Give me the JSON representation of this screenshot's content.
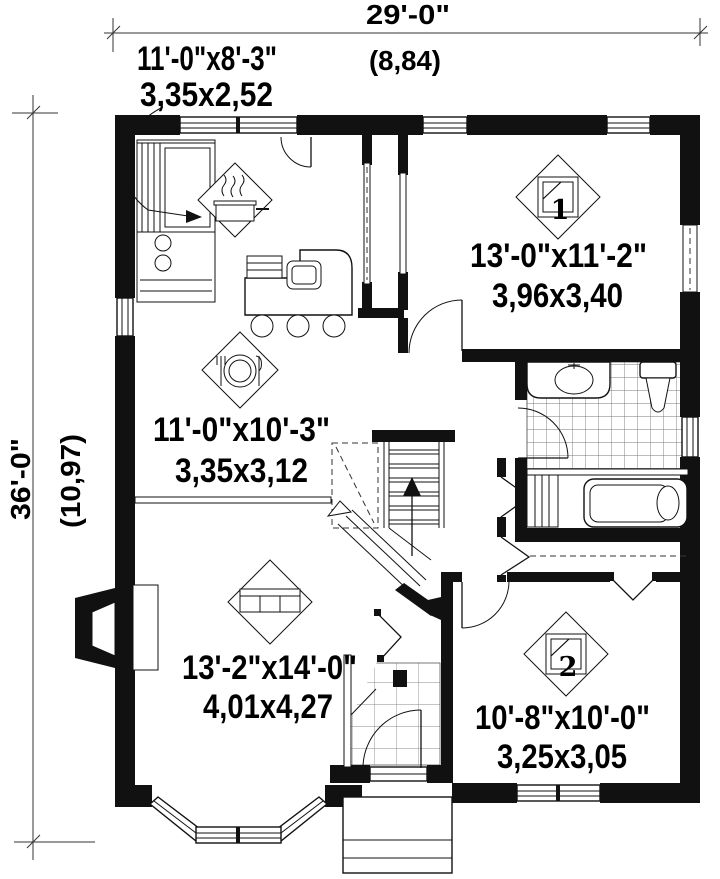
{
  "plan": {
    "type": "house-first-floor-plan",
    "overall": {
      "width_imperial": "29'-0\"",
      "width_metric": "(8,84)",
      "height_imperial": "36'-0\"",
      "height_metric": "(10,97)"
    },
    "rooms": {
      "kitchen": {
        "imperial": "11'-0\"x8'-3\"",
        "metric": "3,35x2,52"
      },
      "bedroom1": {
        "imperial": "13'-0\"x11'-2\"",
        "metric": "3,96x3,40",
        "number": "1"
      },
      "dining": {
        "imperial": "11'-0\"x10'-3\"",
        "metric": "3,35x3,12"
      },
      "living": {
        "imperial": "13'-2\"x14'-0\"",
        "metric": "4,01x4,27"
      },
      "bedroom2": {
        "imperial": "10'-8\"x10'-0\"",
        "metric": "3,25x3,05",
        "number": "2"
      }
    },
    "icons": {
      "kitchen": "cooking-pot",
      "dining": "plate-and-cutlery",
      "living": "sofa",
      "bedrooms": "bed-number-badge"
    },
    "colors": {
      "line": "#111111",
      "background": "#ffffff"
    }
  }
}
